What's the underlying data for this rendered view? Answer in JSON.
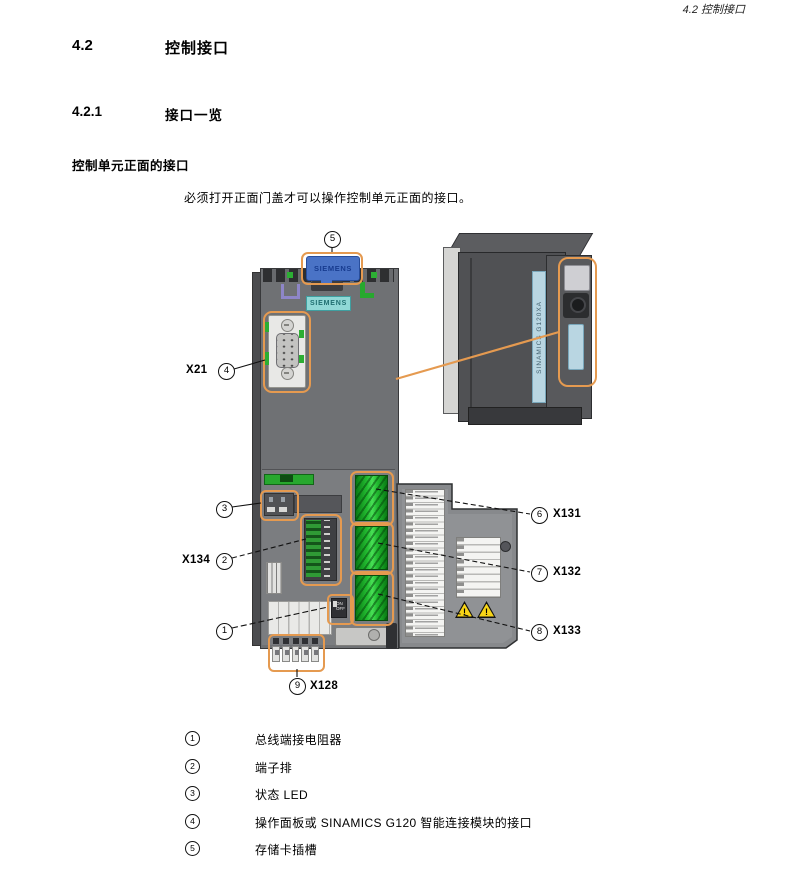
{
  "header": {
    "running_title": "4.2 控制接口"
  },
  "section": {
    "number": "4.2",
    "title": "控制接口"
  },
  "subsection": {
    "number": "4.2.1",
    "title": "接口一览"
  },
  "content": {
    "block_title": "控制单元正面的接口",
    "intro": "必须打开正面门盖才可以操作控制单元正面的接口。"
  },
  "diagram": {
    "memory_card_label": "SIEMENS",
    "front_label": "SIEMENS",
    "side_label": "SINAMICS G120XA",
    "bus_switch": {
      "on": "ON",
      "off": "OFF"
    },
    "ports": {
      "x21": "X21",
      "x134": "X134",
      "x128": "X128",
      "x131": "X131",
      "x132": "X132",
      "x133": "X133"
    },
    "callouts": [
      "1",
      "2",
      "3",
      "4",
      "5",
      "6",
      "7",
      "8",
      "9"
    ]
  },
  "legend": {
    "items": [
      {
        "num": "1",
        "text": "总线端接电阻器"
      },
      {
        "num": "2",
        "text": "端子排"
      },
      {
        "num": "3",
        "text": "状态 LED"
      },
      {
        "num": "4",
        "text": "操作面板或 SINAMICS G120 智能连接模块的接口"
      },
      {
        "num": "5",
        "text": "存储卡插槽"
      }
    ]
  },
  "colors": {
    "highlight_orange": "#E59A50",
    "terminal_green": "#22BB30",
    "card_blue": "#4A73C6",
    "label_teal": "#90D8D6",
    "warning_yellow": "#F7D417",
    "unit_gray": "#6F7174"
  }
}
